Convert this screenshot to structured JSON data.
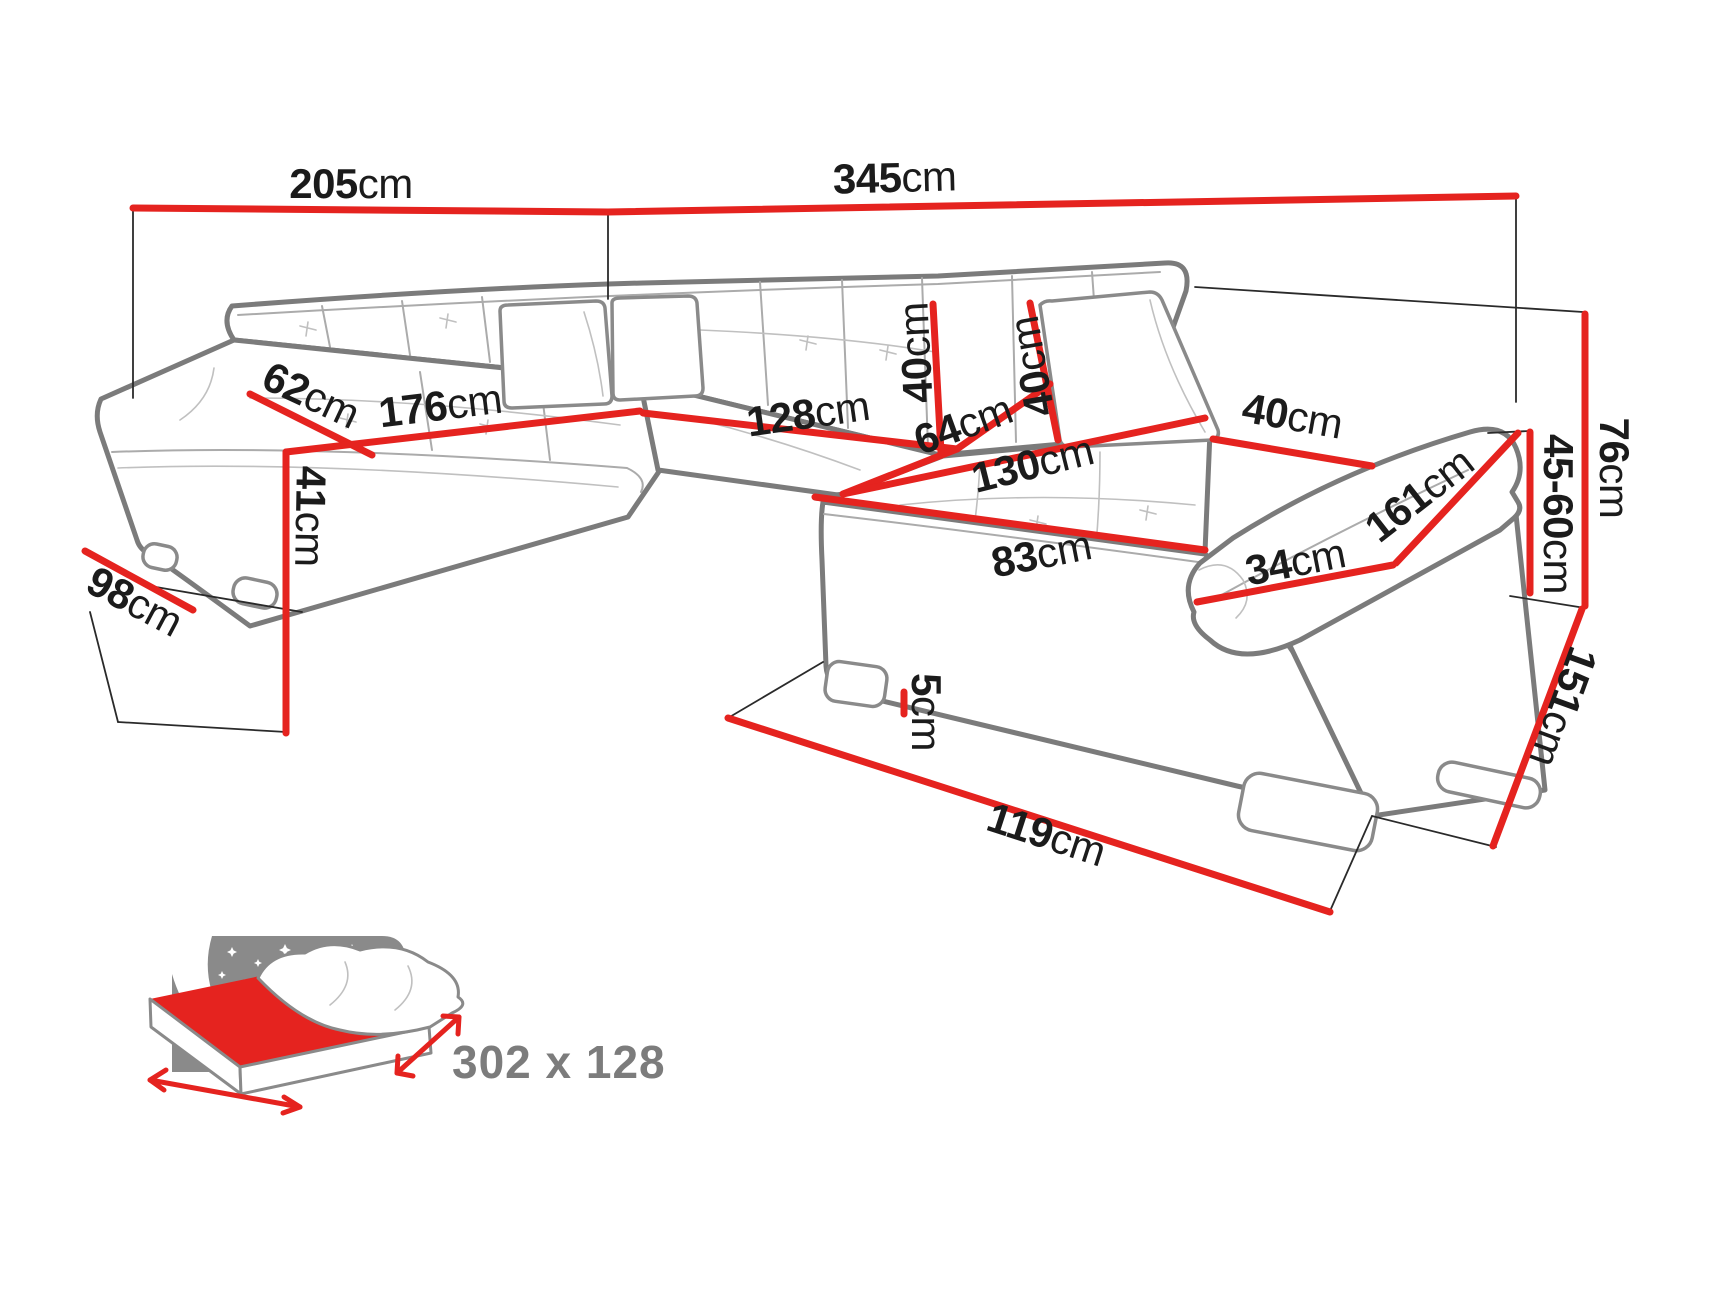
{
  "title": "Corner sofa dimensions diagram",
  "colors": {
    "dimension_red": "#e5231f",
    "sofa_outline_gray": "#7b7b7b",
    "seam_gray": "#ababab",
    "label_black": "#1b1b1b",
    "icon_gray": "#8a8a8a",
    "background": "#ffffff"
  },
  "measurements": {
    "m205": {
      "num": "205",
      "unit": "cm"
    },
    "m345": {
      "num": "345",
      "unit": "cm"
    },
    "m62": {
      "num": "62",
      "unit": "cm"
    },
    "m176": {
      "num": "176",
      "unit": "cm"
    },
    "m41": {
      "num": "41",
      "unit": "cm"
    },
    "m98": {
      "num": "98",
      "unit": "cm"
    },
    "m128": {
      "num": "128",
      "unit": "cm"
    },
    "m64": {
      "num": "64",
      "unit": "cm"
    },
    "m40back": {
      "num": "40",
      "unit": "cm"
    },
    "m40ph": {
      "num": "40",
      "unit": "cm"
    },
    "m40pw": {
      "num": "40",
      "unit": "cm"
    },
    "m130": {
      "num": "130",
      "unit": "cm"
    },
    "m83": {
      "num": "83",
      "unit": "cm"
    },
    "m34": {
      "num": "34",
      "unit": "cm"
    },
    "m161": {
      "num": "161",
      "unit": "cm"
    },
    "m76": {
      "num": "76",
      "unit": "cm"
    },
    "m4560": {
      "num": "45-60",
      "unit": "cm"
    },
    "m151": {
      "num": "151",
      "unit": "cm"
    },
    "m119": {
      "num": "119",
      "unit": "cm"
    },
    "m5": {
      "num": "5",
      "unit": "cm"
    }
  },
  "sleeping_area": {
    "size": "302 x 128",
    "icon": "bed-night-sky-icon"
  }
}
